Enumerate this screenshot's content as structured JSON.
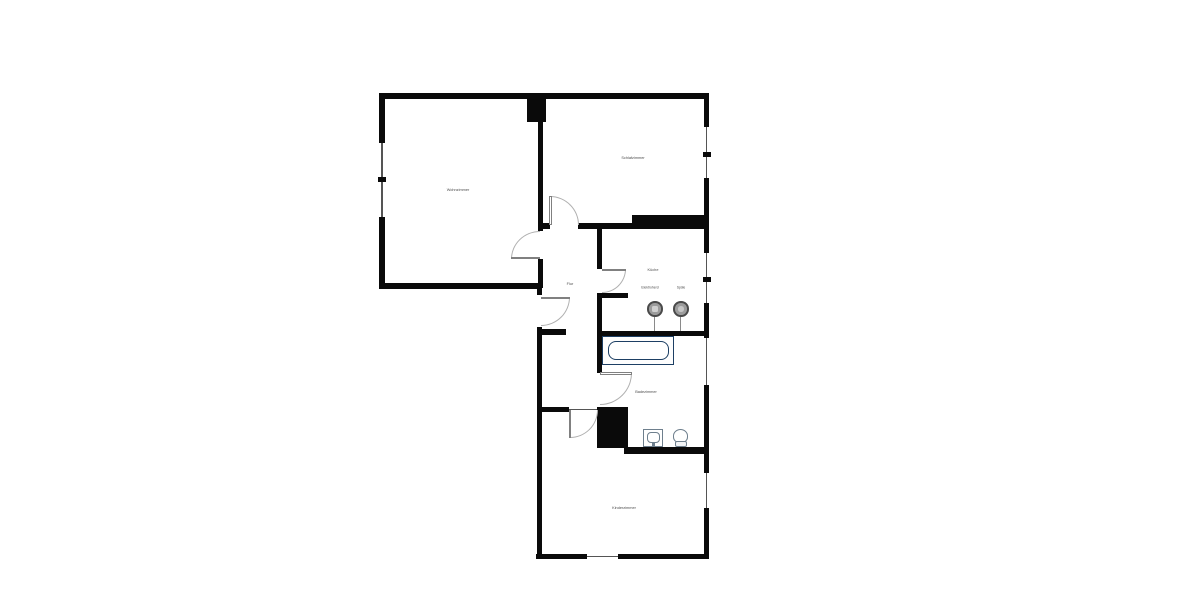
{
  "plan": {
    "colors": {
      "bg": "#ffffff",
      "wall": "#0a0a0a",
      "window": "#555555",
      "arc": "#b0b0b0",
      "leaf": "#808080",
      "label": "#4d4d4d",
      "tub": "#1d3f64",
      "fixture": "#6e7f8d"
    },
    "rooms": [
      {
        "name": "wohnzimmer",
        "label": "Wohnzimmer",
        "x": 458,
        "y": 189.5
      },
      {
        "name": "schlafzimmer",
        "label": "Schlafzimmer",
        "x": 633,
        "y": 158
      },
      {
        "name": "kueche",
        "label": "Küche",
        "x": 653,
        "y": 270
      },
      {
        "name": "flur",
        "label": "Flur",
        "x": 569.5,
        "y": 284
      },
      {
        "name": "badezimmer",
        "label": "Badezimmer",
        "x": 646,
        "y": 392
      },
      {
        "name": "kinderzimmer",
        "label": "Kinderzimmer",
        "x": 623.5,
        "y": 508
      }
    ],
    "fixture_labels": [
      {
        "name": "elektroherd",
        "label": "Elektroherd",
        "x": 650,
        "y": 288
      },
      {
        "name": "spuele",
        "label": "Spüle",
        "x": 681,
        "y": 288
      }
    ],
    "walls": [
      {
        "id": "top",
        "x": 379,
        "y": 93,
        "w": 330,
        "h": 5.5
      },
      {
        "id": "left-upper",
        "x": 379,
        "y": 93,
        "w": 5.5,
        "h": 50
      },
      {
        "id": "left-lower",
        "x": 379,
        "y": 217,
        "w": 5.5,
        "h": 71
      },
      {
        "id": "wohnzimmer-bottom",
        "x": 379,
        "y": 283,
        "w": 163,
        "h": 5.5
      },
      {
        "id": "right-schlaf-upper",
        "x": 703.5,
        "y": 93,
        "w": 5.5,
        "h": 34
      },
      {
        "id": "right-schlaf-lower",
        "x": 703.5,
        "y": 178,
        "w": 5.5,
        "h": 75
      },
      {
        "id": "right-kueche-lower",
        "x": 703.5,
        "y": 303,
        "w": 5.5,
        "h": 35
      },
      {
        "id": "right-bad-lower",
        "x": 703.5,
        "y": 385,
        "w": 5.5,
        "h": 88
      },
      {
        "id": "right-kinder-lower",
        "x": 703.5,
        "y": 508,
        "w": 5.5,
        "h": 51
      },
      {
        "id": "bottom-left",
        "x": 536,
        "y": 553.5,
        "w": 51,
        "h": 5.5
      },
      {
        "id": "bottom-right",
        "x": 618,
        "y": 553.5,
        "w": 91,
        "h": 5.5
      },
      {
        "id": "lower-left-upper",
        "x": 536.5,
        "y": 283,
        "w": 5,
        "h": 12
      },
      {
        "id": "lower-left-lower",
        "x": 536.5,
        "y": 327,
        "w": 5,
        "h": 232
      },
      {
        "id": "wohnzimmer-right-1",
        "x": 537.5,
        "y": 98,
        "w": 5,
        "h": 133
      },
      {
        "id": "wohnzimmer-right-2",
        "x": 537.5,
        "y": 259,
        "w": 5,
        "h": 29
      },
      {
        "id": "chimney",
        "x": 527,
        "y": 95,
        "w": 19,
        "h": 27
      },
      {
        "id": "schlaf-bottom-1",
        "x": 540,
        "y": 223,
        "w": 10,
        "h": 5.5
      },
      {
        "id": "schlaf-bottom-2",
        "x": 578,
        "y": 223,
        "w": 54,
        "h": 5.5
      },
      {
        "id": "schlaf-thick-block",
        "x": 632,
        "y": 215,
        "w": 72,
        "h": 13.5
      },
      {
        "id": "kueche-left-upper",
        "x": 597,
        "y": 225,
        "w": 5,
        "h": 44
      },
      {
        "id": "kueche-left-lower",
        "x": 597,
        "y": 293,
        "w": 5,
        "h": 80
      },
      {
        "id": "kueche-stub",
        "x": 597,
        "y": 293,
        "w": 31,
        "h": 4.5
      },
      {
        "id": "bad-top",
        "x": 597,
        "y": 331,
        "w": 112,
        "h": 5
      },
      {
        "id": "flur-stub",
        "x": 540,
        "y": 328.5,
        "w": 26,
        "h": 6.5
      },
      {
        "id": "hall-kinder",
        "x": 537,
        "y": 407,
        "w": 32,
        "h": 5
      },
      {
        "id": "shaft-block",
        "x": 597,
        "y": 407,
        "w": 31,
        "h": 41
      },
      {
        "id": "bad-bottom",
        "x": 624,
        "y": 447,
        "w": 85,
        "h": 7
      }
    ],
    "windows": [
      {
        "id": "wohnzimmer-window",
        "x": 381,
        "y": 143,
        "w": 1.5,
        "h": 74
      },
      {
        "id": "schlafzimmer-window",
        "x": 705.5,
        "y": 127,
        "w": 1.5,
        "h": 51
      },
      {
        "id": "kueche-window",
        "x": 705.5,
        "y": 253,
        "w": 1.5,
        "h": 50
      },
      {
        "id": "badezimmer-window",
        "x": 705.5,
        "y": 338,
        "w": 1.5,
        "h": 47
      },
      {
        "id": "kinderzimmer-window",
        "x": 705.5,
        "y": 473,
        "w": 1.5,
        "h": 35
      },
      {
        "id": "kinderzimmer-bottom-window",
        "x": 587,
        "y": 555.5,
        "w": 31,
        "h": 1.5
      },
      {
        "id": "kinderzimmer-door-threshold",
        "x": 569,
        "y": 409,
        "w": 28,
        "h": 1
      }
    ],
    "window_ticks": [
      {
        "x": 378,
        "y": 177,
        "w": 7.5,
        "h": 4.5
      },
      {
        "x": 703,
        "y": 152,
        "w": 7.5,
        "h": 4.5
      },
      {
        "x": 703,
        "y": 277,
        "w": 7.5,
        "h": 4.5
      }
    ],
    "doors": [
      {
        "name": "wohnzimmer-door",
        "x": 511,
        "y": 231,
        "w": 29,
        "h": 28,
        "corner": "tl",
        "leaf": {
          "x": 511,
          "y": 256.5,
          "w": 29,
          "h": 2.5
        }
      },
      {
        "name": "schlafzimmer-door",
        "x": 550,
        "y": 196,
        "w": 29,
        "h": 29,
        "corner": "tr",
        "leaf": {
          "x": 549,
          "y": 196,
          "w": 2.5,
          "h": 29
        }
      },
      {
        "name": "kueche-door",
        "x": 602,
        "y": 269,
        "w": 24,
        "h": 24,
        "corner": "br",
        "leaf": {
          "x": 602,
          "y": 268.5,
          "w": 24,
          "h": 2.5
        }
      },
      {
        "name": "entrance-door",
        "x": 541,
        "y": 297,
        "w": 29,
        "h": 29,
        "corner": "br",
        "leaf": {
          "x": 541,
          "y": 296.5,
          "w": 29,
          "h": 2.5
        }
      },
      {
        "name": "badezimmer-door",
        "x": 600,
        "y": 373,
        "w": 32,
        "h": 32,
        "corner": "br",
        "leaf": {
          "x": 600,
          "y": 372,
          "w": 32,
          "h": 2.5
        }
      },
      {
        "name": "kinderzimmer-door",
        "x": 570,
        "y": 410,
        "w": 28,
        "h": 28,
        "corner": "br",
        "leaf": {
          "x": 568.5,
          "y": 410,
          "w": 2.5,
          "h": 28
        }
      }
    ],
    "fixtures": [
      {
        "name": "bathtub",
        "x": 602,
        "y": 336,
        "w": 72,
        "h": 29
      },
      {
        "name": "bathtub-basin",
        "x": 607.5,
        "y": 341,
        "w": 61,
        "h": 19
      },
      {
        "name": "stove-icon",
        "x": 647,
        "y": 301,
        "w": 15.5,
        "h": 15.5
      },
      {
        "name": "stove-center",
        "x": 652,
        "y": 306,
        "w": 5.5,
        "h": 5.5
      },
      {
        "name": "stove-leader",
        "x": 654,
        "y": 317,
        "w": 1,
        "h": 14
      },
      {
        "name": "kitchen-sink-icon",
        "x": 673,
        "y": 301,
        "w": 15.5,
        "h": 15.5
      },
      {
        "name": "kitchen-sink-center",
        "x": 678,
        "y": 306,
        "w": 5.5,
        "h": 5.5
      },
      {
        "name": "kitchen-sink-leader",
        "x": 680,
        "y": 317,
        "w": 1,
        "h": 14
      },
      {
        "name": "washbasin-icon",
        "x": 643,
        "y": 429,
        "w": 20,
        "h": 18
      },
      {
        "name": "washbasin-bowl",
        "x": 646.5,
        "y": 431.5,
        "w": 13,
        "h": 11
      },
      {
        "name": "washbasin-tap",
        "x": 651.5,
        "y": 442,
        "w": 3,
        "h": 5
      },
      {
        "name": "toilet-bowl-icon",
        "x": 673,
        "y": 429,
        "w": 15,
        "h": 14
      },
      {
        "name": "toilet-base",
        "x": 674.5,
        "y": 441,
        "w": 12,
        "h": 6
      }
    ]
  }
}
